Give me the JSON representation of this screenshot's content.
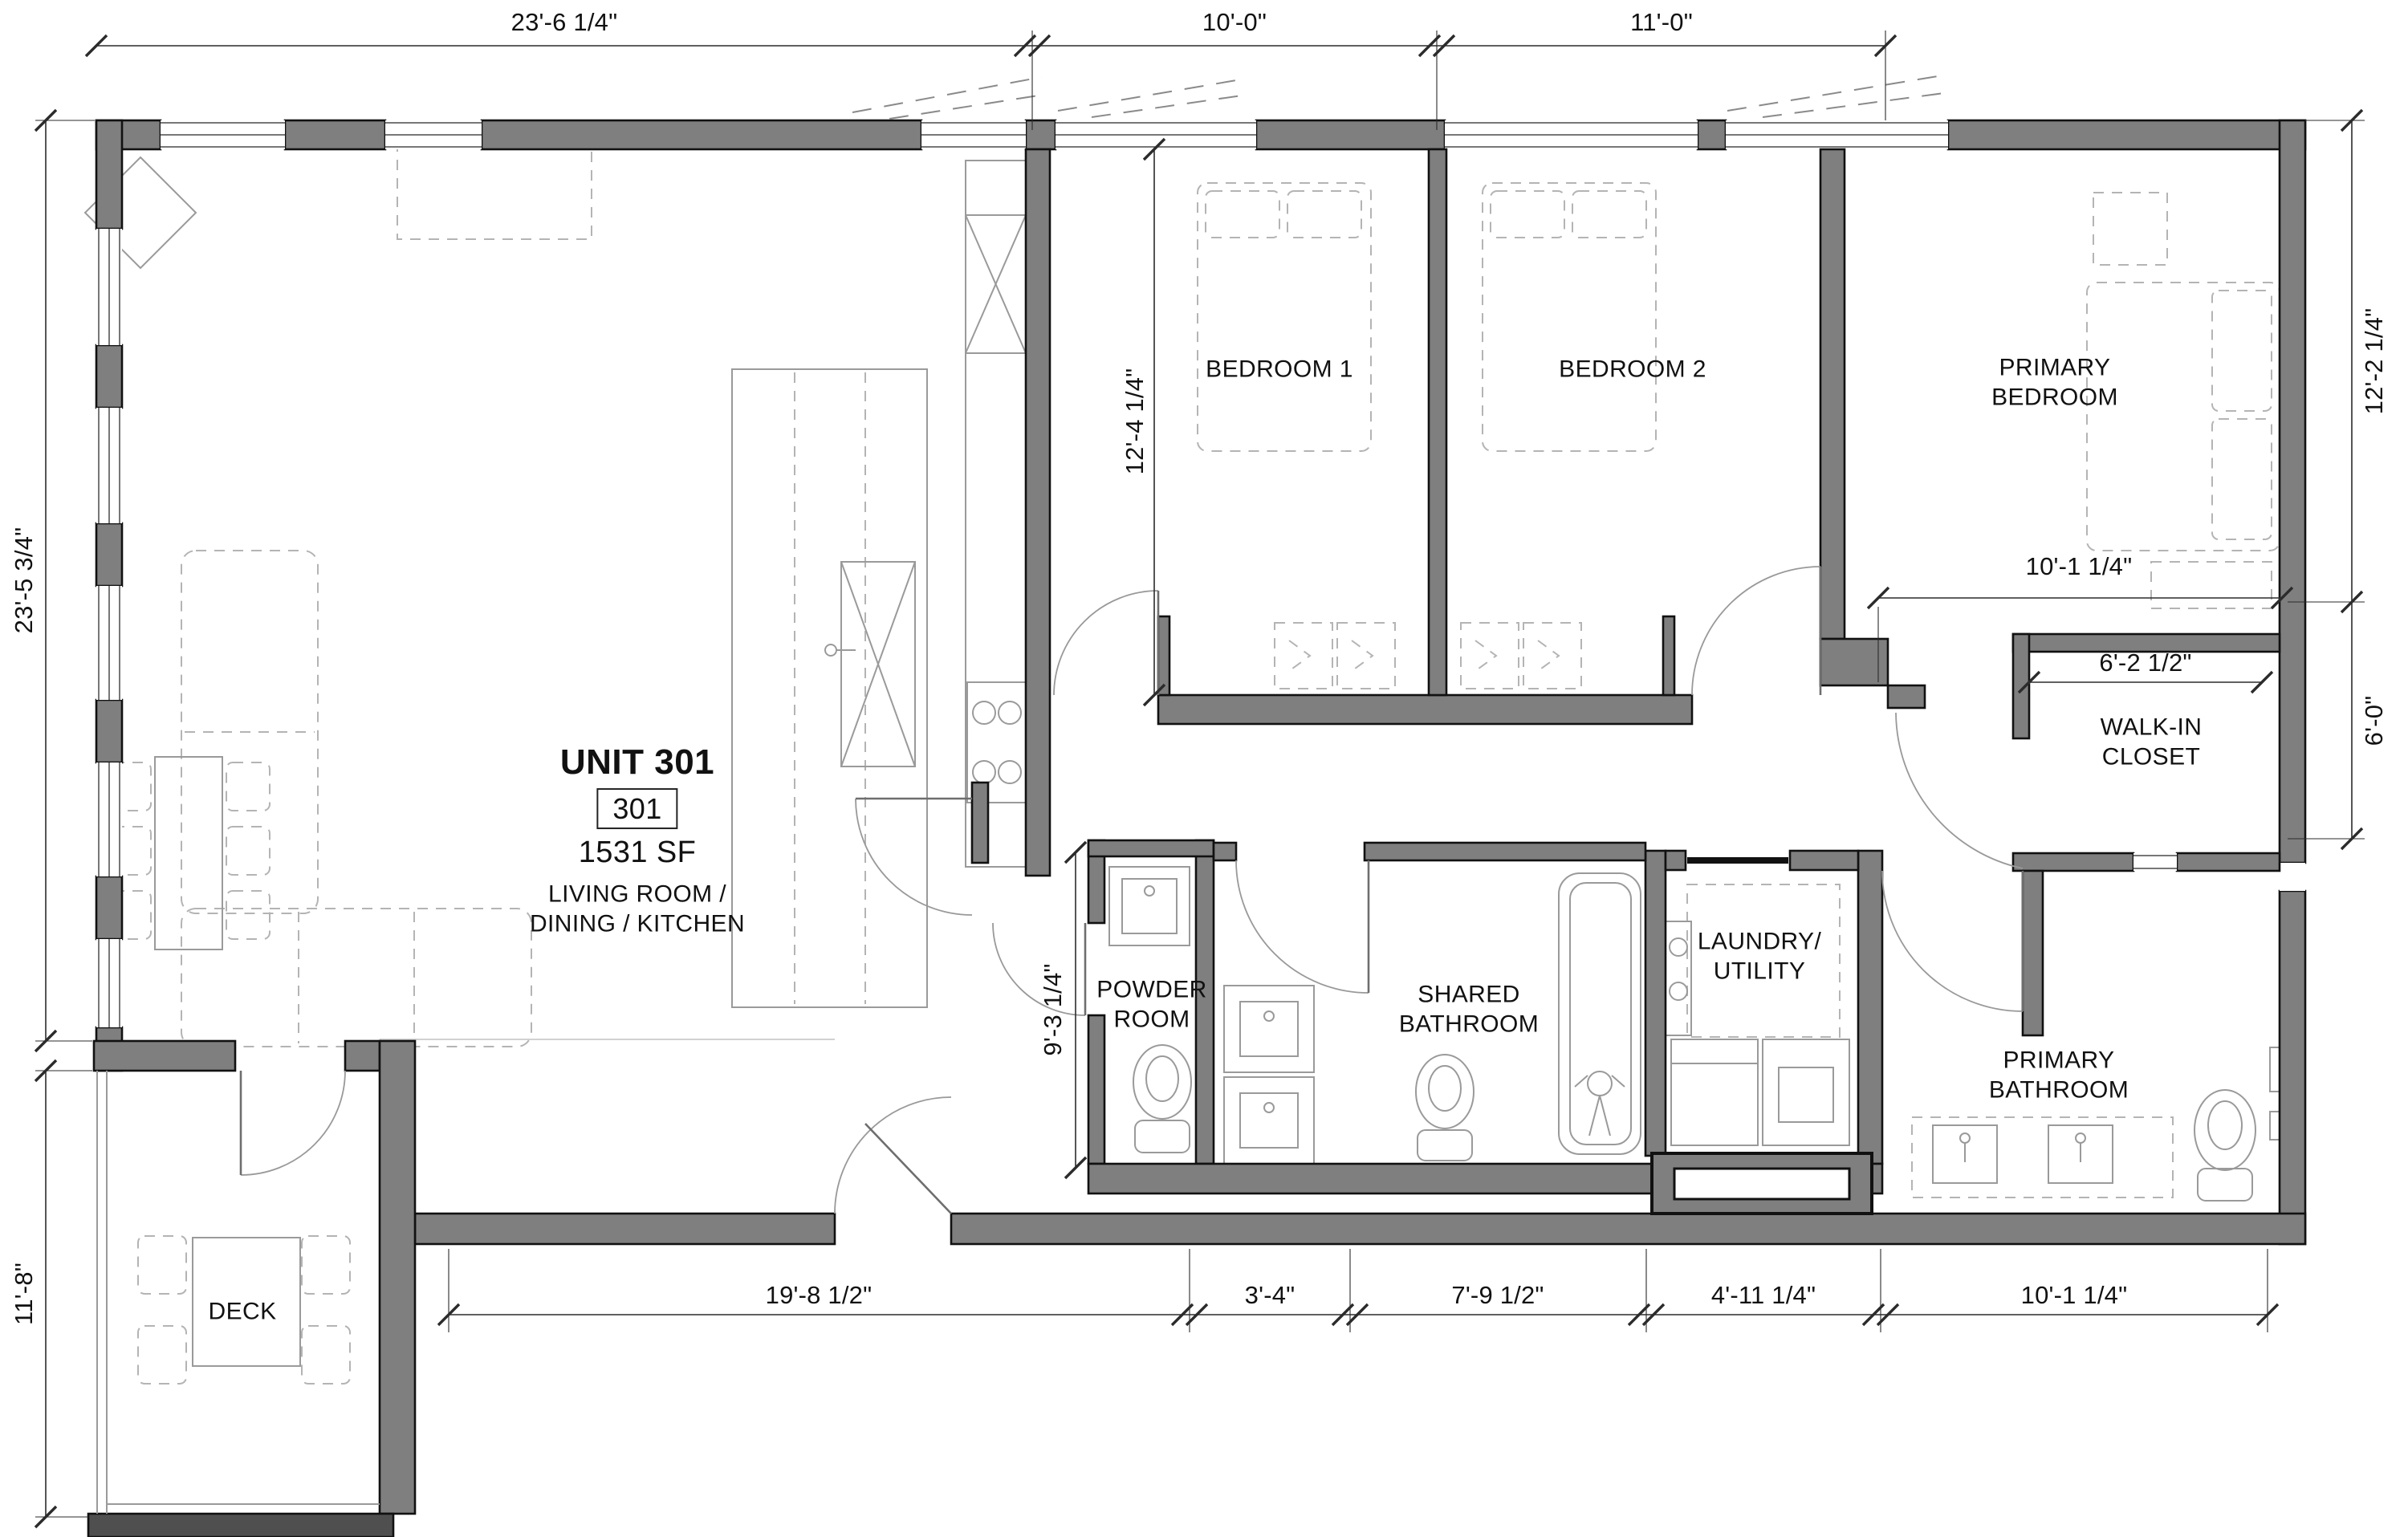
{
  "unit": {
    "title": "UNIT 301",
    "number": "301",
    "area": "1531 SF",
    "space_label": "LIVING ROOM /\nDINING / KITCHEN"
  },
  "rooms": {
    "bedroom1": "BEDROOM 1",
    "bedroom2": "BEDROOM 2",
    "primary_bedroom": "PRIMARY\nBEDROOM",
    "walk_in_closet": "WALK-IN\nCLOSET",
    "laundry": "LAUNDRY/\nUTILITY",
    "powder": "POWDER\nROOM",
    "shared_bath": "SHARED\nBATHROOM",
    "primary_bath": "PRIMARY\nBATHROOM",
    "deck": "DECK"
  },
  "dimensions": {
    "top": [
      "23'-6 1/4\"",
      "10'-0\"",
      "11'-0\""
    ],
    "left_upper": "23'-5 3/4\"",
    "left_lower": "11'-8\"",
    "right_upper": "12'-2 1/4\"",
    "right_lower": "6'-0\"",
    "bedroom_depth": "12'-4 1/4\"",
    "primary_width": "10'-1 1/4\"",
    "closet_width": "6'-2 1/2\"",
    "bath_depth": "9'-3 1/4\"",
    "bottom": [
      "19'-8 1/2\"",
      "3'-4\"",
      "7'-9 1/2\"",
      "4'-11 1/4\"",
      "10'-1 1/4\""
    ]
  },
  "colors": {
    "wall": "#7f7f7f",
    "wall_dark": "#4f4f4f",
    "line": "#111111",
    "dim": "#2b2b2b",
    "furniture": "#b4b4b4",
    "fixture": "#9a9a9a"
  }
}
